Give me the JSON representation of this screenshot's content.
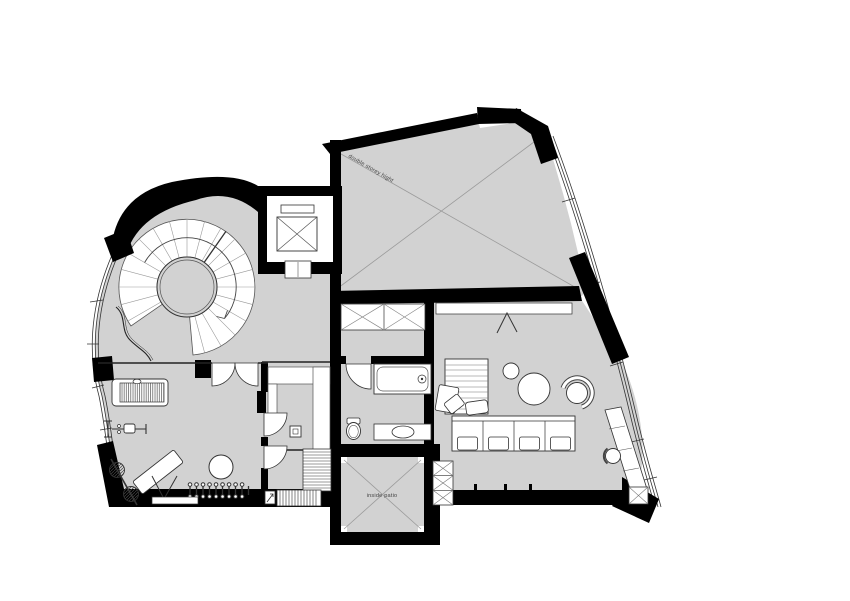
{
  "document": {
    "type": "architectural floor plan",
    "background": "#ffffff"
  },
  "palette": {
    "floor_fill": "#d2d2d2",
    "wall_fill": "#000000",
    "line_strong": "#333333",
    "line_faint": "#9b9b9b",
    "fixture_fill": "#ffffff",
    "label_color": "#444444"
  },
  "labels": {
    "double_height_room": "double storey hight",
    "inside_patio": "inside patio"
  },
  "features": [
    "spiral-staircase",
    "elevator",
    "double-height-void",
    "inside-patio",
    "l-shaped-staircase",
    "bathroom-bathtub",
    "bathroom-toilet",
    "bathroom-basin",
    "walk-in-closet",
    "gym-treadmill",
    "gym-machine",
    "gym-bench-barbell",
    "gym-ball",
    "dumbbell-rack",
    "living-sofa",
    "round-tables",
    "tub-chair",
    "daybed",
    "desk-with-chair",
    "curved-glazed-facade-left",
    "curved-glazed-facade-right"
  ]
}
